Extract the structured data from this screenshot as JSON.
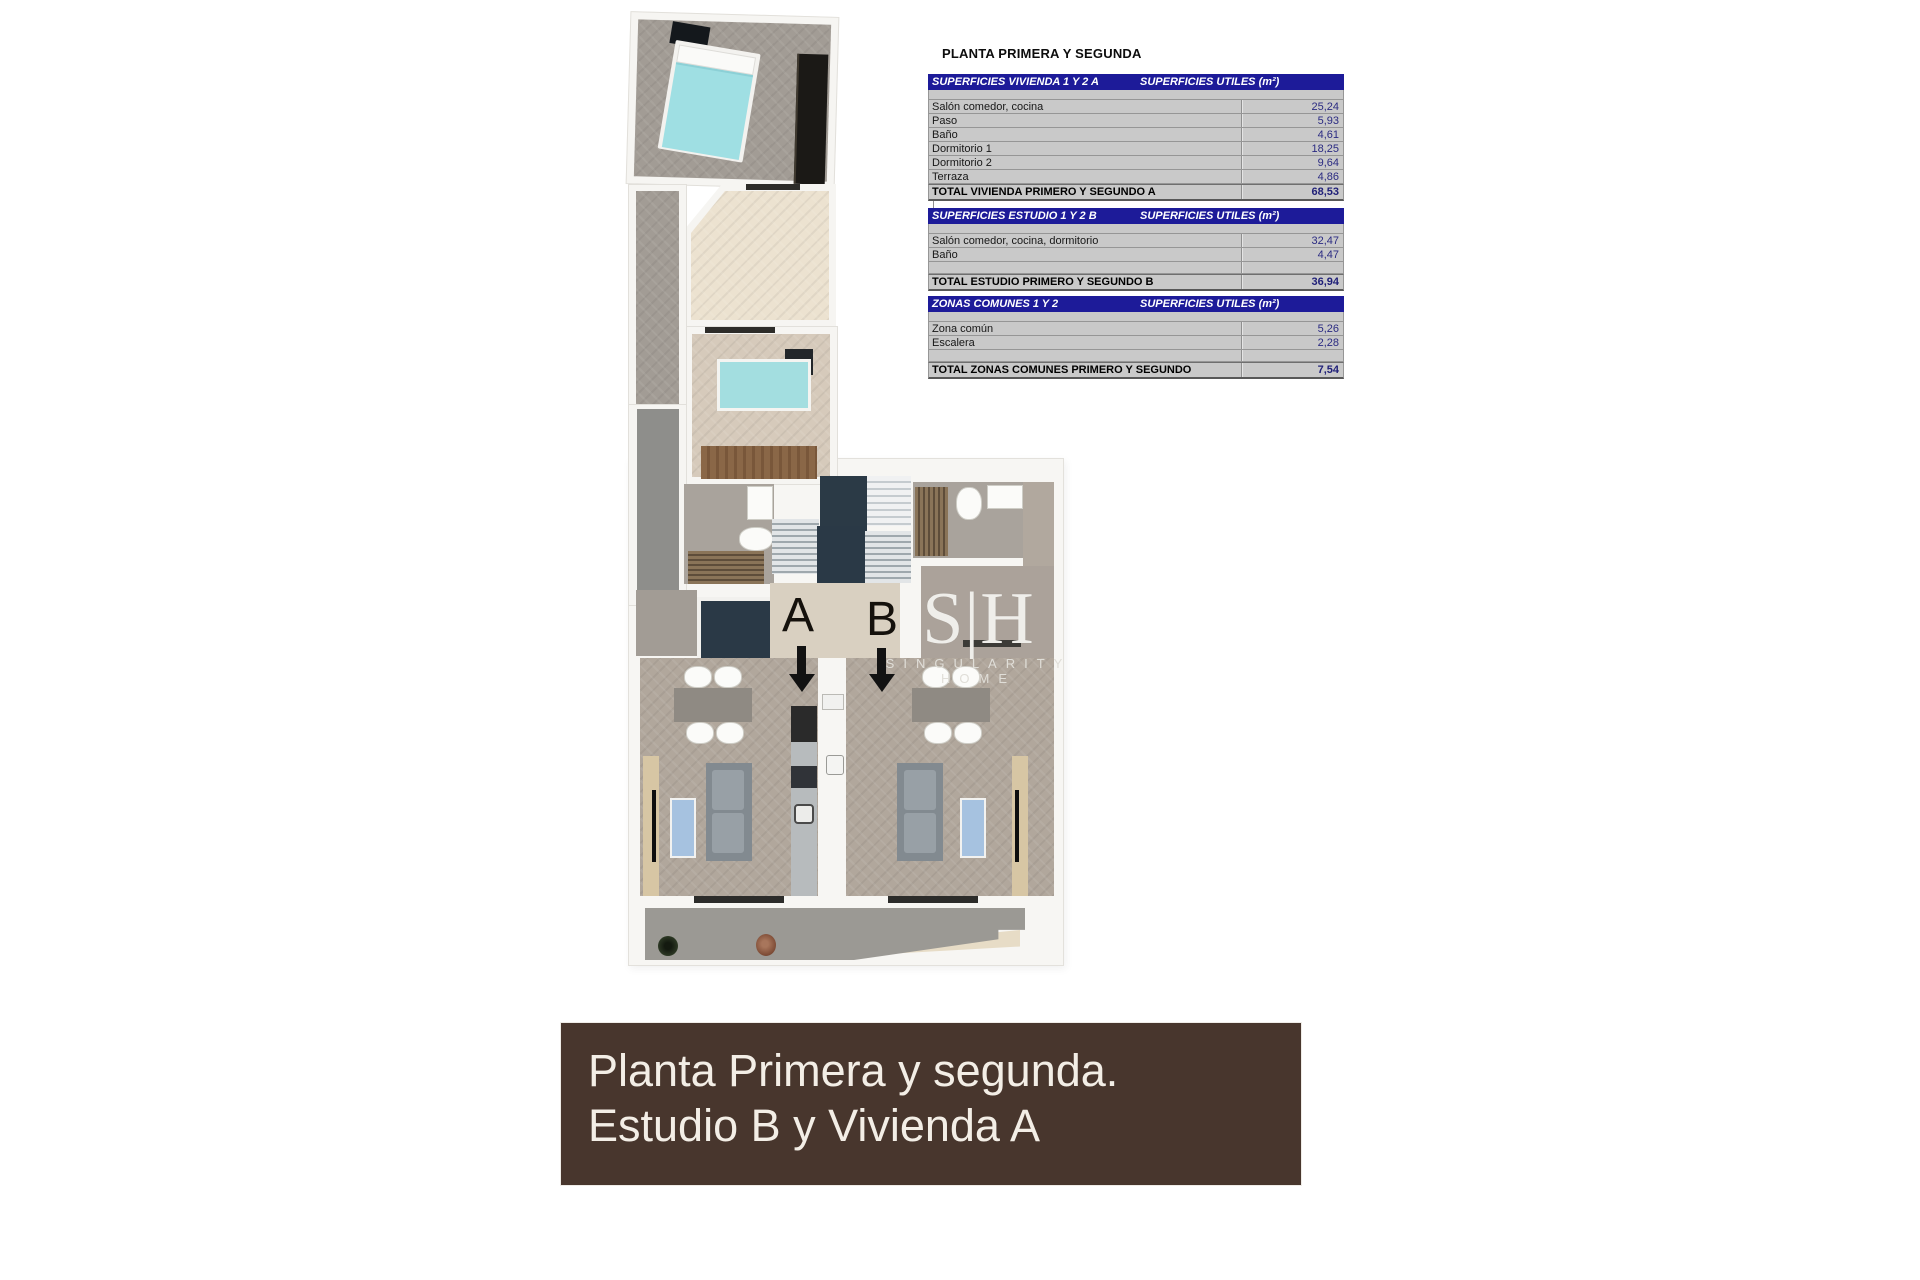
{
  "page_title": "PLANTA PRIMERA Y SEGUNDA",
  "tables": [
    {
      "title": "SUPERFICIES VIVIENDA 1 Y 2 A",
      "units_header": "SUPERFICIES UTILES  (m²)",
      "rows": [
        {
          "label": "Salón comedor, cocina",
          "value": "25,24"
        },
        {
          "label": "Paso",
          "value": "5,93"
        },
        {
          "label": "Baño",
          "value": "4,61"
        },
        {
          "label": "Dormitorio 1",
          "value": "18,25"
        },
        {
          "label": "Dormitorio 2",
          "value": "9,64"
        },
        {
          "label": "Terraza",
          "value": "4,86"
        }
      ],
      "total_label": "TOTAL VIVIENDA PRIMERO Y SEGUNDO A",
      "total_value": "68,53"
    },
    {
      "title": "SUPERFICIES ESTUDIO 1 Y 2 B",
      "units_header": "SUPERFICIES UTILES  (m²)",
      "rows": [
        {
          "label": "Salón comedor, cocina, dormitorio",
          "value": "32,47"
        },
        {
          "label": "Baño",
          "value": "4,47"
        }
      ],
      "total_label": "TOTAL ESTUDIO PRIMERO Y SEGUNDO B",
      "total_value": "36,94"
    },
    {
      "title": "ZONAS COMUNES 1 Y 2",
      "units_header": "SUPERFICIES UTILES  (m²)",
      "rows": [
        {
          "label": "Zona común",
          "value": "5,26"
        },
        {
          "label": "Escalera",
          "value": "2,28"
        }
      ],
      "total_label": "TOTAL ZONAS COMUNES PRIMERO Y SEGUNDO",
      "total_value": "7,54"
    }
  ],
  "plan": {
    "unit_a": "A",
    "unit_b": "B",
    "watermark_logo": "S|H",
    "watermark_name": "SINGULARITY HOME"
  },
  "banner": {
    "line1": "Planta Primera y segunda.",
    "line2": "Estudio B y Vivienda A"
  },
  "colors": {
    "table_header_navy": "#1d1b99",
    "table_row_gray": "#c9c9c9",
    "value_text_navy": "#2b2b82",
    "banner_brown": "#48362d",
    "bed_cyan": "#9fdfe3",
    "navy_tile": "#2a3946",
    "floor_gray": "#a29c95",
    "floor_cream": "#ece2d0",
    "floor_tan": "#d6cabb"
  }
}
